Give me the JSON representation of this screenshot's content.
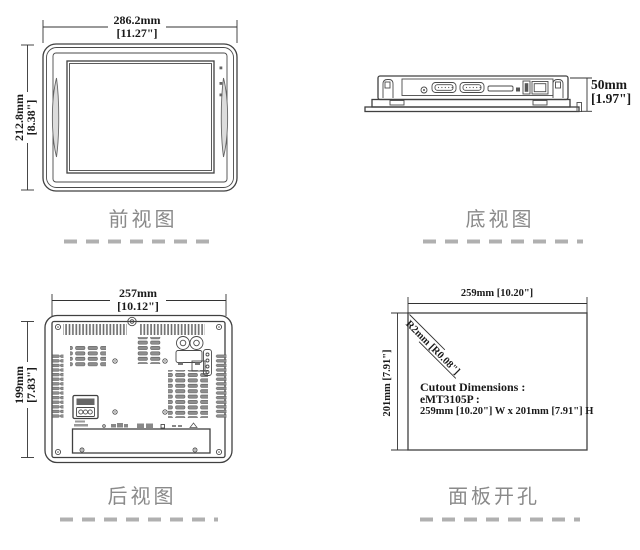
{
  "views": {
    "front": {
      "caption": "前视图",
      "width_value": "286.2mm",
      "width_bracket": "[11.27\"]",
      "height_value": "212.8mm",
      "height_bracket": "[8.38\"]"
    },
    "bottom": {
      "caption": "底视图",
      "depth_value": "50mm",
      "depth_bracket": "[1.97\"]"
    },
    "rear": {
      "caption": "后视图",
      "width_value": "257mm",
      "width_bracket": "[10.12\"]",
      "height_value": "199mm",
      "height_bracket": "[7.83\"]"
    },
    "cutout": {
      "caption": "面板开孔",
      "width_label": "259mm [10.20\"]",
      "height_label": "201mm [7.91\"]",
      "radius_label": "R2mm [R0.08\"]",
      "note": {
        "line1": "Cutout Dimensions :",
        "line2": "eMT3105P :",
        "line3": "259mm [10.20\"] W x 201mm [7.91\"] H"
      }
    }
  },
  "colors": {
    "line": "#404040",
    "dim_text": "#1a1a1a",
    "caption_text": "#8a8a8a",
    "dash": "#b0b0b0",
    "vent": "#8f8f8f"
  }
}
